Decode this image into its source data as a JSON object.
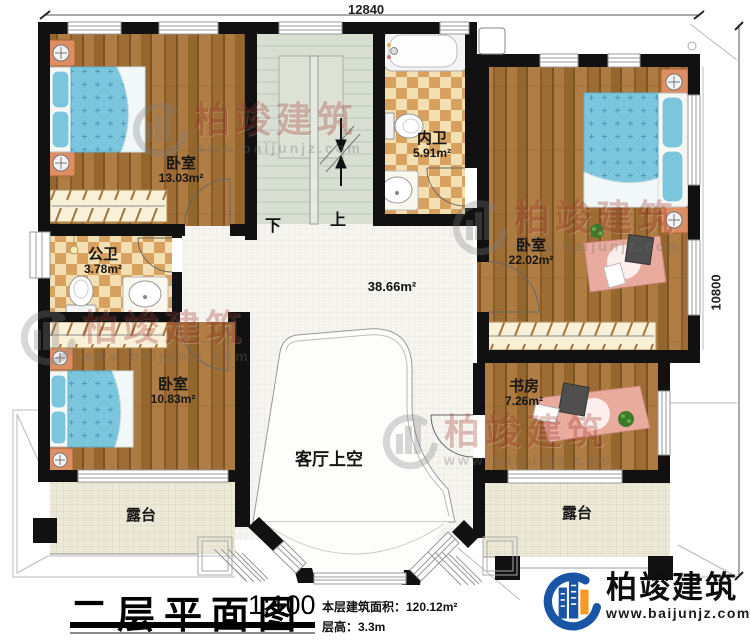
{
  "dimensions": {
    "width_label": "12840",
    "height_label": "10800"
  },
  "rooms": {
    "bedroom_top_left": {
      "name": "卧室",
      "area": "13.03m²"
    },
    "inner_bathroom": {
      "name": "内卫",
      "area": "5.91m²"
    },
    "public_bathroom": {
      "name": "公卫",
      "area": "3.78m²"
    },
    "bedroom_right": {
      "name": "卧室",
      "area": "22.02m²"
    },
    "bedroom_bottom_left": {
      "name": "卧室",
      "area": "10.83m²"
    },
    "study": {
      "name": "书房",
      "area": "7.26m²"
    },
    "hall_area": "38.66m²",
    "living_room_void": "客厅上空",
    "terrace_left": "露台",
    "terrace_right": "露台"
  },
  "stairs": {
    "down_label": "下",
    "up_label": "上"
  },
  "title_block": {
    "title": "二层平面图",
    "scale": "1:100",
    "floor_area_line": "本层建筑面积：120.12m²",
    "floor_height_line": "层高：3.3m"
  },
  "brand": {
    "name": "柏竣建筑",
    "website": "www.baijunjz.com",
    "accent_blue": "#1a55a5",
    "accent_orange": "#f59b22"
  },
  "watermark": {
    "name": "柏竣建筑",
    "website": "www.baijunjz.com"
  }
}
